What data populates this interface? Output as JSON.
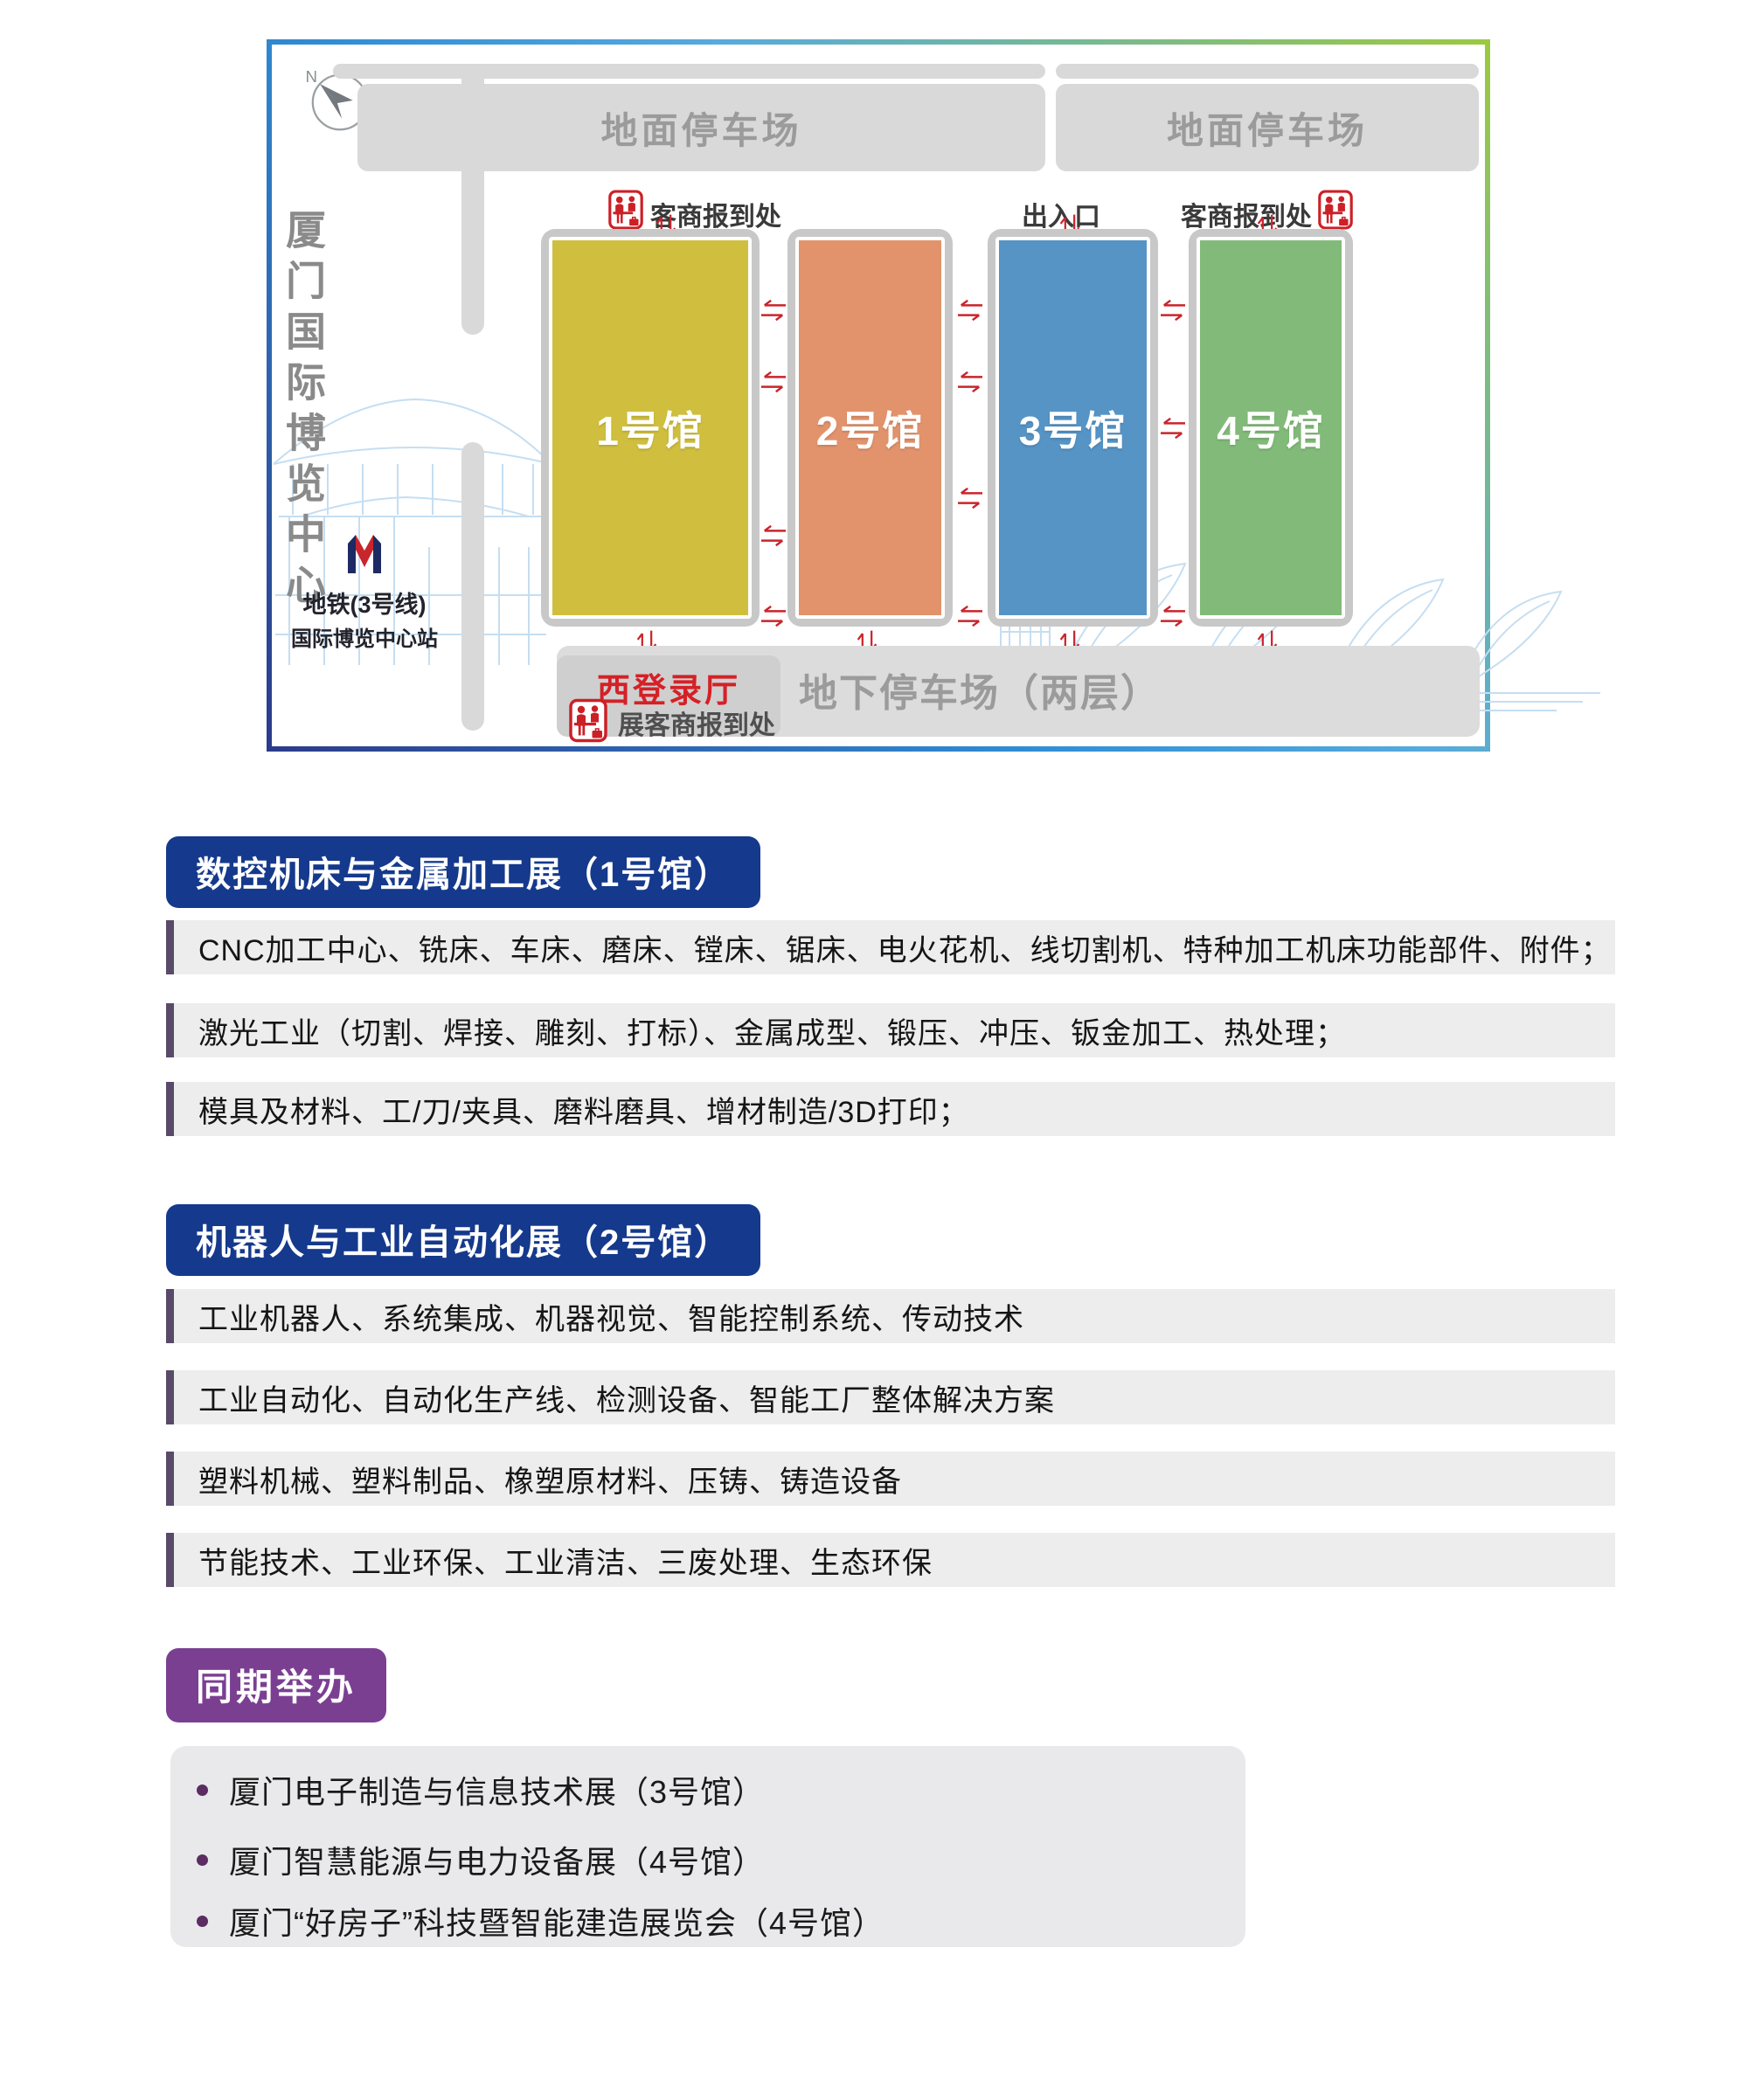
{
  "colors": {
    "map_border_gradient": [
      "#2c3a8a",
      "#2f8ed5",
      "#9cc93f"
    ],
    "section_header_blue": "#15398c",
    "concurrent_header_purple": "#7b3f92",
    "row_stripe_purple": "#584a68",
    "row_background": "#ededee",
    "map_red": "#cc2027",
    "parking_gray": "#d9d9d9",
    "sketch_blue": "#c5def2"
  },
  "map": {
    "compass": {
      "north": "N",
      "south": "S"
    },
    "venue_title": "厦门国际博览中心",
    "metro": {
      "line": "地铁(3号线)",
      "station": "国际博览中心站"
    },
    "parking_left": "地面停车场",
    "parking_right": "地面停车场",
    "registration_left": "客商报到处",
    "entrance": "出入口",
    "registration_right": "客商报到处",
    "halls": [
      {
        "name": "1号馆",
        "color": "#d0bf3e"
      },
      {
        "name": "2号馆",
        "color": "#e2936c"
      },
      {
        "name": "3号馆",
        "color": "#5694c6"
      },
      {
        "name": "4号馆",
        "color": "#82bb79"
      }
    ],
    "west_hall": {
      "title": "西登录厅",
      "subtitle": "展客商报到处"
    },
    "underground_parking": "地下停车场（两层）"
  },
  "sections": [
    {
      "title": "数控机床与金属加工展（1号馆）",
      "rows": [
        "CNC加工中心、铣床、车床、磨床、镗床、锯床、电火花机、线切割机、特种加工机床功能部件、附件；",
        "激光工业（切割、焊接、雕刻、打标）、金属成型、锻压、冲压、钣金加工、热处理；",
        "模具及材料、工/刀/夹具、磨料磨具、增材制造/3D打印；"
      ]
    },
    {
      "title": "机器人与工业自动化展（2号馆）",
      "rows": [
        "工业机器人、系统集成、机器视觉、智能控制系统、传动技术",
        "工业自动化、自动化生产线、检测设备、智能工厂整体解决方案",
        "塑料机械、塑料制品、橡塑原材料、压铸、铸造设备",
        "节能技术、工业环保、工业清洁、三废处理、生态环保"
      ]
    }
  ],
  "concurrent": {
    "title": "同期举办",
    "items": [
      "厦门电子制造与信息技术展（3号馆）",
      "厦门智慧能源与电力设备展（4号馆）",
      "厦门“好房子”科技暨智能建造展览会（4号馆）"
    ]
  }
}
